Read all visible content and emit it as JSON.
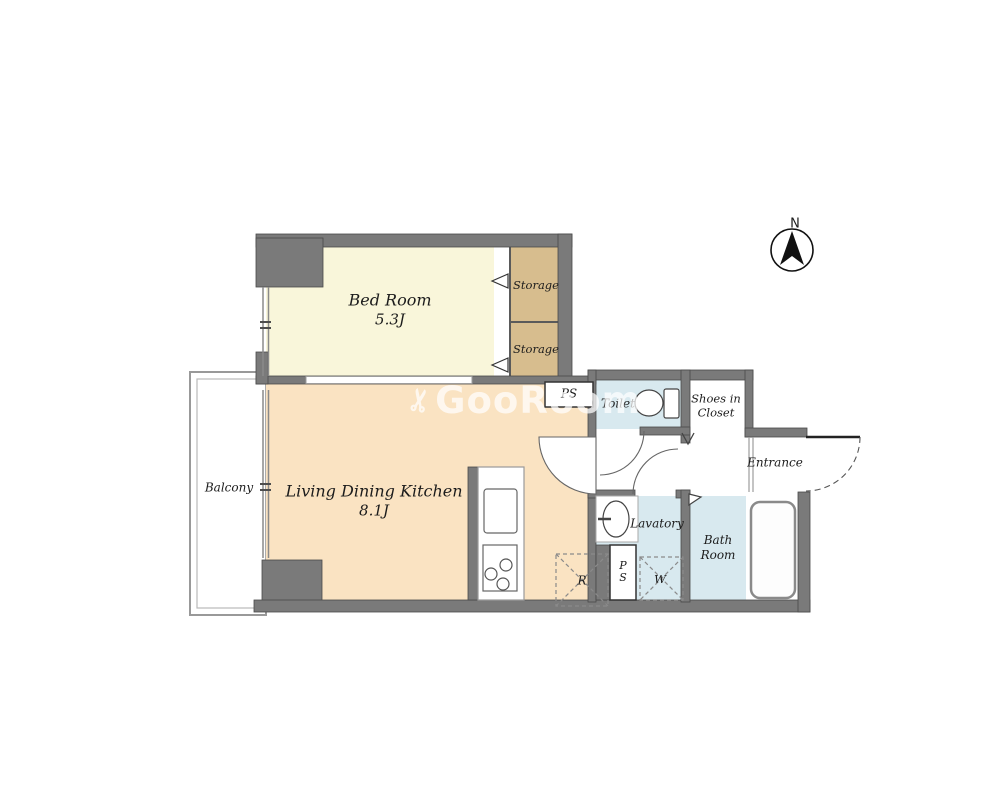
{
  "colors": {
    "wall": "#7a7a7a",
    "bedroom_fill": "#f9f6da",
    "storage_fill": "#d7bd8e",
    "ldk_fill": "#fae3c2",
    "wet_fill": "#d8e9ef",
    "balcony_line": "#999999",
    "watermark": "rgba(255,255,255,0.72)"
  },
  "compass": {
    "north_label": "N"
  },
  "watermark": {
    "icon": "scissors-icon",
    "text": "GooRoom"
  },
  "rooms": {
    "bedroom": {
      "name": "Bed Room",
      "size": "5.3J"
    },
    "living": {
      "name": "Living Dining Kitchen",
      "size": "8.1J"
    },
    "balcony": {
      "name": "Balcony"
    },
    "storage_upper": {
      "name": "Storage"
    },
    "storage_lower": {
      "name": "Storage"
    },
    "toilet": {
      "name": "Toilet"
    },
    "shoes_closet": {
      "name": "Shoes in Closet"
    },
    "entrance": {
      "name": "Entrance"
    },
    "lavatory": {
      "name": "Lavatory"
    },
    "bathroom": {
      "name": "Bath Room"
    }
  },
  "labels": {
    "pipe_shaft_upper": "PS",
    "pipe_shaft_lower": "PS",
    "washing_machine": "W",
    "refrigerator": "R"
  }
}
